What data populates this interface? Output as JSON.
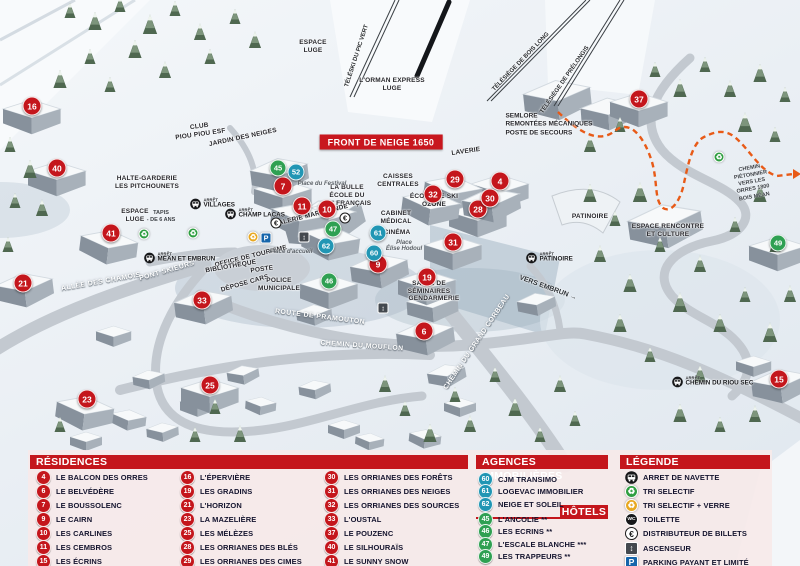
{
  "colors": {
    "red": "#c4161c",
    "blue": "#2196b4",
    "green": "#2fa052",
    "header_red": "#c4161c",
    "banner_red": "#c8171e",
    "panel_bg": "rgba(246,233,233,0.93)",
    "parking_blue": "#1565ab"
  },
  "map": {
    "banner": "FRONT DE NEIGE 1650",
    "strings": {
      "arret": "ARRÊT"
    },
    "markers": [
      {
        "n": 4,
        "t": "r",
        "x": 500,
        "y": 181
      },
      {
        "n": 6,
        "t": "r",
        "x": 424,
        "y": 331
      },
      {
        "n": 7,
        "t": "r",
        "x": 283,
        "y": 186
      },
      {
        "n": 9,
        "t": "r",
        "x": 378,
        "y": 264
      },
      {
        "n": 10,
        "t": "r",
        "x": 327,
        "y": 209
      },
      {
        "n": 11,
        "t": "r",
        "x": 302,
        "y": 206
      },
      {
        "n": 15,
        "t": "r",
        "x": 779,
        "y": 379
      },
      {
        "n": 16,
        "t": "r",
        "x": 32,
        "y": 106
      },
      {
        "n": 19,
        "t": "r",
        "x": 427,
        "y": 277
      },
      {
        "n": 21,
        "t": "r",
        "x": 23,
        "y": 283
      },
      {
        "n": 23,
        "t": "r",
        "x": 87,
        "y": 399
      },
      {
        "n": 25,
        "t": "r",
        "x": 210,
        "y": 385
      },
      {
        "n": 28,
        "t": "r",
        "x": 478,
        "y": 209
      },
      {
        "n": 29,
        "t": "r",
        "x": 455,
        "y": 179
      },
      {
        "n": 30,
        "t": "r",
        "x": 490,
        "y": 198
      },
      {
        "n": 31,
        "t": "r",
        "x": 453,
        "y": 242
      },
      {
        "n": 32,
        "t": "r",
        "x": 433,
        "y": 194
      },
      {
        "n": 33,
        "t": "r",
        "x": 202,
        "y": 300
      },
      {
        "n": 37,
        "t": "r",
        "x": 639,
        "y": 99
      },
      {
        "n": 40,
        "t": "r",
        "x": 57,
        "y": 168
      },
      {
        "n": 41,
        "t": "r",
        "x": 111,
        "y": 233
      },
      {
        "n": 45,
        "t": "g",
        "x": 278,
        "y": 168
      },
      {
        "n": 46,
        "t": "g",
        "x": 329,
        "y": 281
      },
      {
        "n": 47,
        "t": "g",
        "x": 333,
        "y": 229
      },
      {
        "n": 49,
        "t": "g",
        "x": 778,
        "y": 243
      },
      {
        "n": 52,
        "t": "b",
        "x": 296,
        "y": 172
      },
      {
        "n": 60,
        "t": "b",
        "x": 374,
        "y": 253
      },
      {
        "n": 61,
        "t": "b",
        "x": 378,
        "y": 233
      },
      {
        "n": 62,
        "t": "b",
        "x": 326,
        "y": 246
      }
    ],
    "labels": [
      {
        "text": "FRONT DE NEIGE 1650",
        "x": 381,
        "y": 142,
        "rot": 0,
        "cls": "banner"
      },
      {
        "text": "LAVERIE",
        "x": 466,
        "y": 152,
        "rot": -8,
        "cls": "poi"
      },
      {
        "text": "CAISSES\nCENTRALES",
        "x": 398,
        "y": 181,
        "rot": 0,
        "cls": "poi"
      },
      {
        "text": "LA BULLE\nÉCOLE DU\nSKI FRANÇAIS",
        "x": 347,
        "y": 196,
        "rot": 0,
        "cls": "poi"
      },
      {
        "text": "GALERIE MARCHANDE",
        "x": 311,
        "y": 216,
        "rot": -14,
        "cls": "poi"
      },
      {
        "text": "ÉCOLE DE SKI\nOZONE",
        "x": 434,
        "y": 201,
        "rot": 0,
        "cls": "poi"
      },
      {
        "text": "CABINET\nMÉDICAL",
        "x": 396,
        "y": 218,
        "rot": 0,
        "cls": "poi"
      },
      {
        "text": "CINÉMA",
        "x": 397,
        "y": 233,
        "rot": 0,
        "cls": "poi"
      },
      {
        "text": "SALLE DE\nSÉMINAIRES",
        "x": 429,
        "y": 288,
        "rot": 0,
        "cls": "poi"
      },
      {
        "text": "GENDARMERIE",
        "x": 434,
        "y": 299,
        "rot": 0,
        "cls": "poi"
      },
      {
        "text": "OFFICE DE TOURISME",
        "x": 251,
        "y": 257,
        "rot": -14,
        "cls": "poi"
      },
      {
        "text": "BIBLIOTHÈQUE",
        "x": 231,
        "y": 267,
        "rot": -10,
        "cls": "poi"
      },
      {
        "text": "POSTE",
        "x": 262,
        "y": 270,
        "rot": -8,
        "cls": "poi"
      },
      {
        "text": "DÉPOSE CARS",
        "x": 245,
        "y": 284,
        "rot": -16,
        "cls": "poi"
      },
      {
        "text": "POLICE\nMUNICIPALE",
        "x": 279,
        "y": 285,
        "rot": 0,
        "cls": "poi"
      },
      {
        "text": "HALTE-GARDERIE\nLES PITCHOUNETS",
        "x": 147,
        "y": 183,
        "rot": 0,
        "cls": "poi"
      },
      {
        "text": "CLUB\nPIOU PIOU ESF",
        "x": 200,
        "y": 131,
        "rot": -8,
        "cls": "poi"
      },
      {
        "text": "JARDIN DES NEIGES",
        "x": 243,
        "y": 138,
        "rot": -12,
        "cls": "poi"
      },
      {
        "text": "ESPACE\nLUGE",
        "x": 135,
        "y": 216,
        "rot": 0,
        "cls": "poi"
      },
      {
        "text": "TAPIS\n- DE 6 ANS",
        "x": 161,
        "y": 217,
        "rot": 0,
        "cls": "tiny"
      },
      {
        "text": "ESPACE\nLUGE",
        "x": 313,
        "y": 47,
        "rot": 0,
        "cls": "poi"
      },
      {
        "text": "PATINOIRE",
        "x": 590,
        "y": 217,
        "rot": 0,
        "cls": "poi"
      },
      {
        "text": "ESPACE RENCONTRE\nET CULTURE",
        "x": 668,
        "y": 231,
        "rot": 0,
        "cls": "poi"
      },
      {
        "text": "SEMLORE\nREMONTÉES MÉCANIQUES\nPOSTE DE SECOURS",
        "x": 549,
        "y": 125,
        "rot": 0,
        "cls": "poileft"
      },
      {
        "text": "L'ORMAN EXPRESS\nLUGE",
        "x": 392,
        "y": 85,
        "rot": 0,
        "cls": "poi"
      },
      {
        "text": "Place du Festival",
        "x": 322,
        "y": 184,
        "rot": 0,
        "cls": "place"
      },
      {
        "text": "Place d'accueil",
        "x": 291,
        "y": 252,
        "rot": 0,
        "cls": "place"
      },
      {
        "text": "Place\nÉlise Hodoul",
        "x": 404,
        "y": 246,
        "rot": 0,
        "cls": "place"
      },
      {
        "text": "ALLÉE DES CHAMOIS",
        "x": 101,
        "y": 282,
        "rot": -10,
        "cls": "road"
      },
      {
        "text": "PONT SKIEURS",
        "x": 167,
        "y": 271,
        "rot": -16,
        "cls": "road"
      },
      {
        "text": "ROUTE DE PRAMOUTON",
        "x": 320,
        "y": 317,
        "rot": 7,
        "cls": "road"
      },
      {
        "text": "CHEMIN DU MOUFLON",
        "x": 362,
        "y": 346,
        "rot": 4,
        "cls": "road"
      },
      {
        "text": "CHEMIN DU GRAND CORBEAU",
        "x": 477,
        "y": 342,
        "rot": -56,
        "cls": "road"
      },
      {
        "text": "CHEMIN PIÉTONNIER\nVERS LES ORRES 1800\nBOIS MÉAN",
        "x": 752,
        "y": 183,
        "rot": -10,
        "cls": "tiny"
      },
      {
        "text": "VERS EMBRUN →",
        "x": 548,
        "y": 288,
        "rot": 20,
        "cls": "way"
      }
    ],
    "bus_stops": [
      {
        "name": "VILLAGES",
        "x": 196,
        "y": 204
      },
      {
        "name": "CHAMP LACAS",
        "x": 231,
        "y": 214
      },
      {
        "name": "MÉAN ET EMBRUN",
        "x": 150,
        "y": 258
      },
      {
        "name": "PATINOIRE",
        "x": 532,
        "y": 258
      },
      {
        "name": "CHEMIN DU RIOU SEC",
        "x": 678,
        "y": 382
      }
    ],
    "icons": [
      {
        "t": "recycle-green",
        "x": 144,
        "y": 234
      },
      {
        "t": "recycle-green",
        "x": 193,
        "y": 233
      },
      {
        "t": "recycle-green",
        "x": 719,
        "y": 157
      },
      {
        "t": "recycle-yellow",
        "x": 253,
        "y": 237
      },
      {
        "t": "parking",
        "x": 266,
        "y": 238
      },
      {
        "t": "euro",
        "x": 276,
        "y": 223
      },
      {
        "t": "euro",
        "x": 345,
        "y": 218
      },
      {
        "t": "elevator",
        "x": 304,
        "y": 237
      },
      {
        "t": "elevator",
        "x": 383,
        "y": 308
      }
    ],
    "lifts": [
      {
        "name": "TÉLÉSKI DU PIC VERT",
        "x1": 397,
        "y1": 0,
        "x2": 352,
        "y2": 97,
        "lx": 357,
        "ly": 56,
        "rot": -72
      },
      {
        "name": "TÉLÉSIÈGE DE BOIS LONG",
        "x1": 588,
        "y1": 0,
        "x2": 489,
        "y2": 101,
        "lx": 521,
        "ly": 62,
        "rot": -46
      },
      {
        "name": "TÉLÉSIÈGE DE PRÉLONGIS",
        "x1": 622,
        "y1": 0,
        "x2": 556,
        "y2": 106,
        "lx": 565,
        "ly": 80,
        "rot": -55
      }
    ]
  },
  "panel": {
    "residences": {
      "title": "RÉSIDENCES",
      "items": [
        {
          "n": 4,
          "label": "LE BALCON DES ORRES"
        },
        {
          "n": 6,
          "label": "LE BELVÉDÈRE"
        },
        {
          "n": 7,
          "label": "LE BOUSSOLENC"
        },
        {
          "n": 9,
          "label": "LE CAIRN"
        },
        {
          "n": 10,
          "label": "LES CARLINES"
        },
        {
          "n": 11,
          "label": "LES CEMBROS"
        },
        {
          "n": 15,
          "label": "LES ÉCRINS"
        },
        {
          "n": 16,
          "label": "L'ÉPERVIÈRE"
        },
        {
          "n": 19,
          "label": "LES GRADINS"
        },
        {
          "n": 21,
          "label": "L'HORIZON"
        },
        {
          "n": 23,
          "label": "LA MAZELIÈRE"
        },
        {
          "n": 25,
          "label": "LES MÉLÈZES"
        },
        {
          "n": 28,
          "label": "LES ORRIANES DES BLÉS"
        },
        {
          "n": 29,
          "label": "LES ORRIANES DES CIMES"
        },
        {
          "n": 30,
          "label": "LES ORRIANES DES FORÊTS"
        },
        {
          "n": 31,
          "label": "LES ORRIANES DES NEIGES"
        },
        {
          "n": 32,
          "label": "LES ORRIANES DES SOURCES"
        },
        {
          "n": 33,
          "label": "L'OUSTAL"
        },
        {
          "n": 37,
          "label": "LE POUZENC"
        },
        {
          "n": 40,
          "label": "LE SILHOURAÏS"
        },
        {
          "n": 41,
          "label": "LE SUNNY SNOW"
        }
      ]
    },
    "agences": {
      "title": "AGENCES IMMOBILIÈRES",
      "items": [
        {
          "n": 60,
          "label": "CJM TRANSIMO"
        },
        {
          "n": 61,
          "label": "LOGEVAC IMMOBILIER"
        },
        {
          "n": 62,
          "label": "NEIGE ET SOLEIL"
        }
      ]
    },
    "hotels": {
      "title": "HÔTELS",
      "items": [
        {
          "n": 45,
          "label": "L'ANCOLIE **"
        },
        {
          "n": 46,
          "label": "LES ECRINS **"
        },
        {
          "n": 47,
          "label": "L'ESCALE BLANCHE ***"
        },
        {
          "n": 49,
          "label": "LES TRAPPEURS **"
        }
      ]
    },
    "legende": {
      "title": "LÉGENDE",
      "items": [
        {
          "icon": "bus",
          "label": "ARRET DE NAVETTE"
        },
        {
          "icon": "recycle-green",
          "label": "TRI SELECTIF"
        },
        {
          "icon": "recycle-yellow",
          "label": "TRI SELECTIF + VERRE"
        },
        {
          "icon": "wc",
          "label": "TOILETTE"
        },
        {
          "icon": "euro",
          "label": "DISTRIBUTEUR DE BILLETS"
        },
        {
          "icon": "elevator",
          "label": "ASCENSEUR"
        },
        {
          "icon": "parking",
          "label": "PARKING PAYANT ET LIMITÉ"
        }
      ]
    }
  }
}
